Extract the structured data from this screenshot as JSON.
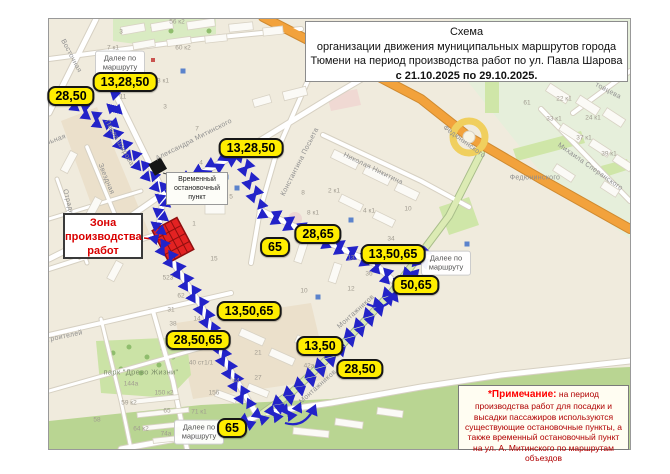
{
  "title_box": {
    "line1": "Схема",
    "line2": "организации движения муниципальных маршрутов города",
    "line3": "Тюмени на период производства работ по ул. Павла Шарова",
    "line4": "с 21.10.2025 по 29.10.2025."
  },
  "note_box": {
    "heading": "*Примечание:",
    "body": " на период производства работ для посадки и высадки пассажиров используются существующие остановочные пункты, а также временный остановочный пункт на ул. А. Митинского по маршрутам объездов"
  },
  "work_zone_label": {
    "line1": "Зона",
    "line2": "производства",
    "line3": "работ"
  },
  "temp_stop_label": "Временный остановочный пункт",
  "route_continue_label": "Далее по маршруту",
  "route_badges": [
    {
      "text": "28,50",
      "x": 71,
      "y": 96
    },
    {
      "text": "13,28,50",
      "x": 125,
      "y": 82
    },
    {
      "text": "13,28,50",
      "x": 251,
      "y": 148
    },
    {
      "text": "28,65",
      "x": 318,
      "y": 234
    },
    {
      "text": "65",
      "x": 275,
      "y": 247
    },
    {
      "text": "13,50,65",
      "x": 393,
      "y": 254
    },
    {
      "text": "50,65",
      "x": 416,
      "y": 285
    },
    {
      "text": "13,50,65",
      "x": 249,
      "y": 311
    },
    {
      "text": "28,50,65",
      "x": 198,
      "y": 340
    },
    {
      "text": "13,50",
      "x": 320,
      "y": 346
    },
    {
      "text": "28,50",
      "x": 360,
      "y": 369
    },
    {
      "text": "65",
      "x": 232,
      "y": 428
    }
  ],
  "continue_labels": [
    {
      "x": 120,
      "y": 63
    },
    {
      "x": 446,
      "y": 263
    },
    {
      "x": 199,
      "y": 432
    }
  ],
  "map": {
    "street_labels": [
      {
        "text": "Восточная",
        "x": 70,
        "y": 55,
        "a": 62
      },
      {
        "text": "Павла Шарова",
        "x": 118,
        "y": 142,
        "a": 60
      },
      {
        "text": "Александра Митинского",
        "x": 193,
        "y": 139,
        "a": -27
      },
      {
        "text": "Звездная",
        "x": 105,
        "y": 178,
        "a": 68
      },
      {
        "text": "Отрадная",
        "x": 68,
        "y": 205,
        "a": 75
      },
      {
        "text": "льная",
        "x": 55,
        "y": 139,
        "a": -20
      },
      {
        "text": "Мирная",
        "x": 88,
        "y": 250,
        "a": -16
      },
      {
        "text": "Константина Посьета",
        "x": 299,
        "y": 161,
        "a": -63
      },
      {
        "text": "Николая Никитина",
        "x": 372,
        "y": 168,
        "a": 26
      },
      {
        "text": "Федюнинского",
        "x": 463,
        "y": 141,
        "a": 36
      },
      {
        "text": "Федюнинского",
        "x": 534,
        "y": 177,
        "a": 0
      },
      {
        "text": "Михаила Сперанского",
        "x": 589,
        "y": 166,
        "a": 35
      },
      {
        "text": "товцева",
        "x": 607,
        "y": 90,
        "a": 28
      },
      {
        "text": "Монтажников",
        "x": 355,
        "y": 311,
        "a": -42
      },
      {
        "text": "Монтажников",
        "x": 317,
        "y": 386,
        "a": -42
      },
      {
        "text": "строителей",
        "x": 62,
        "y": 336,
        "a": -12
      },
      {
        "text": "парк \"Древо Жизни\"",
        "x": 140,
        "y": 371,
        "a": 0,
        "park": true
      }
    ],
    "building_labels": [
      [
        "56 к2",
        176,
        21
      ],
      [
        "3",
        120,
        31
      ],
      [
        "7 к1",
        112,
        47
      ],
      [
        "60 к2",
        182,
        47
      ],
      [
        "3 к1",
        162,
        80
      ],
      [
        "11",
        122,
        96
      ],
      [
        "3",
        164,
        106
      ],
      [
        "7",
        196,
        128
      ],
      [
        "4",
        200,
        162
      ],
      [
        "1",
        193,
        223
      ],
      [
        "5",
        230,
        196
      ],
      [
        "15",
        213,
        258
      ],
      [
        "8 к1",
        312,
        212
      ],
      [
        "2 к1",
        333,
        190
      ],
      [
        "4 к1",
        368,
        210
      ],
      [
        "8",
        302,
        192
      ],
      [
        "10",
        407,
        208
      ],
      [
        "34",
        390,
        238
      ],
      [
        "13",
        350,
        257
      ],
      [
        "36",
        368,
        273
      ],
      [
        "12",
        350,
        288
      ],
      [
        "10",
        303,
        290
      ],
      [
        "62",
        180,
        295
      ],
      [
        "523",
        167,
        277
      ],
      [
        "31",
        170,
        309
      ],
      [
        "14",
        196,
        318
      ],
      [
        "38",
        172,
        323
      ],
      [
        "21",
        257,
        352
      ],
      [
        "42а",
        308,
        365
      ],
      [
        "27",
        257,
        377
      ],
      [
        "44",
        235,
        380
      ],
      [
        "40 ст1/1",
        200,
        362
      ],
      [
        "144а",
        130,
        383
      ],
      [
        "150 к2",
        163,
        392
      ],
      [
        "156",
        213,
        392
      ],
      [
        "59 к2",
        128,
        402
      ],
      [
        "58",
        96,
        419
      ],
      [
        "64 к2",
        140,
        428
      ],
      [
        "65",
        166,
        410
      ],
      [
        "71 к1",
        198,
        411
      ],
      [
        "74а",
        165,
        433
      ],
      [
        "61",
        526,
        102
      ],
      [
        "22 к1",
        563,
        98
      ],
      [
        "33 к1",
        553,
        118
      ],
      [
        "24 к1",
        592,
        117
      ],
      [
        "37 к1",
        583,
        137
      ],
      [
        "39 к1",
        608,
        153
      ]
    ]
  },
  "colors": {
    "badge_bg": "#ffed00",
    "arrow_blue": "#2323c8",
    "work_zone_red": "#e32222",
    "work_zone_dark": "#8f0f0f",
    "note_heading_red": "#ff0000",
    "note_body_red": "#b00000",
    "highway_orange": "#f2a23c",
    "green_road": "#dcebb4",
    "map_bg": "#f0ebdd"
  }
}
